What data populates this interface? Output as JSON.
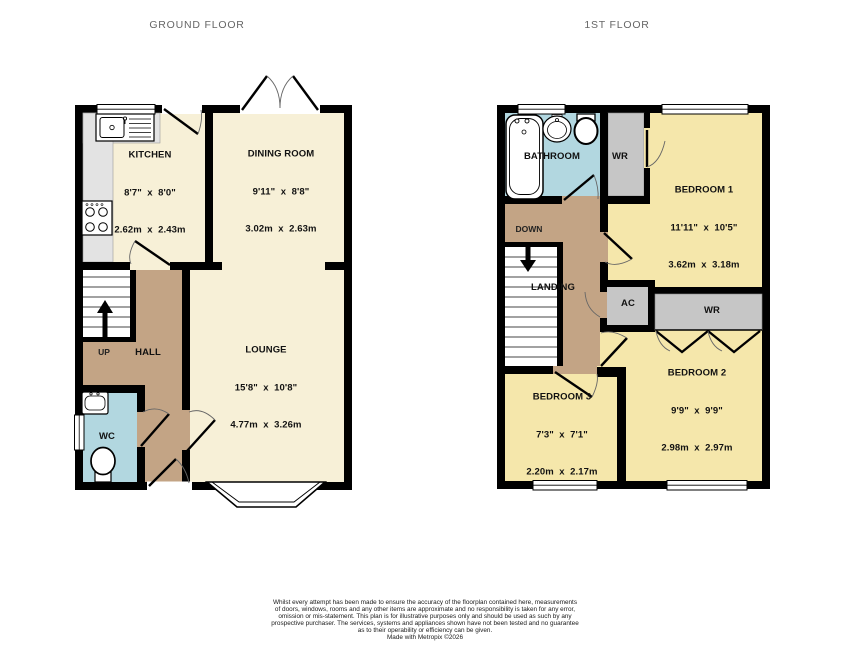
{
  "titles": {
    "ground": "GROUND FLOOR",
    "first": "1ST FLOOR"
  },
  "colors": {
    "wall": "#000000",
    "ground_room": "#f7f0d7",
    "bedroom": "#f5e7ab",
    "hall_landing": "#c3a485",
    "wet_room": "#b2d7e0",
    "storage_gray": "#c6c6c6",
    "counter_gray": "#e3e3e3",
    "title_text": "#666666"
  },
  "ground_floor": {
    "rooms": {
      "kitchen": {
        "name": "KITCHEN",
        "imperial": "8'7\"  x  8'0\"",
        "metric": "2.62m  x  2.43m"
      },
      "dining": {
        "name": "DINING ROOM",
        "imperial": "9'11\"  x  8'8\"",
        "metric": "3.02m  x  2.63m"
      },
      "lounge": {
        "name": "LOUNGE",
        "imperial": "15'8\"  x  10'8\"",
        "metric": "4.77m  x  3.26m"
      },
      "hall": {
        "name": "HALL"
      },
      "wc": {
        "name": "WC"
      }
    },
    "stairs_label": "UP"
  },
  "first_floor": {
    "rooms": {
      "bathroom": {
        "name": "BATHROOM"
      },
      "wr_top": {
        "name": "WR"
      },
      "bedroom1": {
        "name": "BEDROOM 1",
        "imperial": "11'11\"  x  10'5\"",
        "metric": "3.62m  x  3.18m"
      },
      "landing": {
        "name": "LANDING"
      },
      "ac": {
        "name": "AC"
      },
      "wr_mid": {
        "name": "WR"
      },
      "bedroom2": {
        "name": "BEDROOM 2",
        "imperial": "9'9\"  x  9'9\"",
        "metric": "2.98m  x  2.97m"
      },
      "bedroom3": {
        "name": "BEDROOM 3",
        "imperial": "7'3\"  x  7'1\"",
        "metric": "2.20m  x  2.17m"
      }
    },
    "stairs_label": "DOWN"
  },
  "disclaimer": {
    "lines": [
      "Whilst every attempt has been made to ensure the accuracy of the floorplan contained here, measurements",
      "of doors, windows, rooms and any other items are approximate and no responsibility is taken for any error,",
      "omission or mis-statement. This plan is for illustrative purposes only and should be used as such by any",
      "prospective purchaser. The services, systems and appliances shown have not been tested and no guarantee",
      "as to their operability or efficiency can be given.",
      "Made with Metropix ©2026"
    ]
  }
}
